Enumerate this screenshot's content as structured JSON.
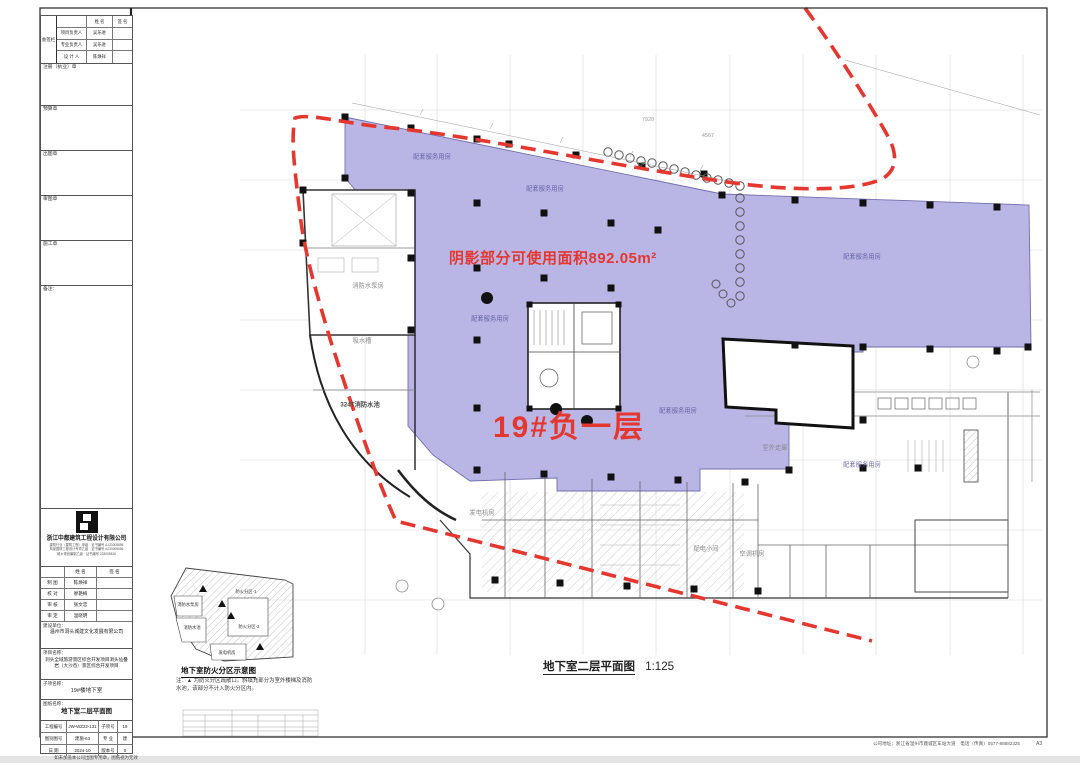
{
  "colors": {
    "red": "#e4372f",
    "purple": "#b6b3e5"
  },
  "title_block": {
    "sign_label": "会签栏",
    "top_table": {
      "headers": [
        "姓 名",
        "签 名"
      ],
      "rows": [
        {
          "label": "项目负责人",
          "name": "吴乐进"
        },
        {
          "label": "专业负责人",
          "name": "吴乐进"
        },
        {
          "label": "设 计 人",
          "name": "陈焕祥"
        }
      ]
    },
    "boxes": [
      "注册（执业）章",
      "预算章",
      "出图章",
      "审图章",
      "施工章",
      "备注："
    ],
    "company_name": "浙江中都建筑工程设计有限公司",
    "certs": [
      "建筑行业（建筑工程）甲级　证书编号 A133005656",
      "风景园林工程设计专项乙级　证书编号 A233005656",
      "城乡规划编制乙级　证书编号 233005816"
    ],
    "staff_table": {
      "headers": [
        "姓 名",
        "签 名"
      ],
      "rows": [
        {
          "label": "制 图",
          "name": "陈焕祥"
        },
        {
          "label": "校 对",
          "name": "廖艳梅"
        },
        {
          "label": "审 核",
          "name": "张文忠"
        },
        {
          "label": "审 定",
          "name": "温晓明"
        }
      ]
    },
    "client_label": "建设单位：",
    "client": "温州市洞头城建文化发展有限公司",
    "project_label": "项目名称：",
    "project": "洞头全域旅游景区综合开发项目洞头仙叠岩（大沙岙）景区综合开发项目",
    "subitem_label": "子项名称：",
    "subitem": "19#楼地下室",
    "sheet_label": "图纸名称：",
    "sheet_name": "地下室二层平面图",
    "info_table": [
      [
        "工程编号",
        "JW-WZ22-131",
        "子项号",
        "19"
      ],
      [
        "图别图号",
        "建施-63",
        "专 业",
        "建"
      ],
      [
        "日 期",
        "2024-10",
        "版本号",
        "0"
      ]
    ],
    "stamp_note": "如未加盖本公司出图专用章，图纸视为无效"
  },
  "plan": {
    "shaded_note": "阴影部分可使用面积892.05m²",
    "floor_label": "19#负一层",
    "caption": "地下室二层平面图",
    "scale": "1:125",
    "room_labels": [
      {
        "t": "配套服务用房",
        "x": 432,
        "y": 156,
        "cls": "lp"
      },
      {
        "t": "配套服务用房",
        "x": 545,
        "y": 188,
        "cls": "lp"
      },
      {
        "t": "配套服务用房",
        "x": 862,
        "y": 256,
        "cls": "lp"
      },
      {
        "t": "配套服务用房",
        "x": 490,
        "y": 318,
        "cls": "lp"
      },
      {
        "t": "配套服务用房",
        "x": 678,
        "y": 410,
        "cls": "lp"
      },
      {
        "t": "配套服务用房",
        "x": 862,
        "y": 464,
        "cls": "lp"
      },
      {
        "t": "消防水泵房",
        "x": 368,
        "y": 285,
        "cls": "lg"
      },
      {
        "t": "吸水槽",
        "x": 362,
        "y": 340,
        "cls": "lg"
      },
      {
        "t": "324T消防水池",
        "x": 360,
        "y": 404,
        "cls": "ld"
      },
      {
        "t": "发电机房",
        "x": 482,
        "y": 512,
        "cls": "lg"
      },
      {
        "t": "配电小间",
        "x": 706,
        "y": 548,
        "cls": "lg"
      },
      {
        "t": "空调机房",
        "x": 752,
        "y": 553,
        "cls": "lg"
      },
      {
        "t": "室外走廊",
        "x": 775,
        "y": 447,
        "cls": "lg"
      }
    ],
    "dims": [
      {
        "t": "7920",
        "x": 648,
        "y": 120
      },
      {
        "t": "4567",
        "x": 708,
        "y": 136
      }
    ]
  },
  "keyplan": {
    "caption": "地下室防火分区示意图",
    "labels": [
      {
        "t": "防火分区-1",
        "x": 246,
        "y": 592
      },
      {
        "t": "防火分区-2",
        "x": 249,
        "y": 627
      },
      {
        "t": "消防水泵房",
        "x": 188,
        "y": 605
      },
      {
        "t": "消防水池",
        "x": 192,
        "y": 628
      },
      {
        "t": "发电机房",
        "x": 227,
        "y": 653
      }
    ],
    "note_lines": "注：▲ 为防火分区疏散口。斜填充部分为室外楼梯及消防水池，该部分不计入防火分区内。"
  },
  "footer": {
    "address": "公司地址：浙江省温州市鹿城区车站大道　电话（传真）0577-88882325",
    "sheet_size": "A3"
  }
}
